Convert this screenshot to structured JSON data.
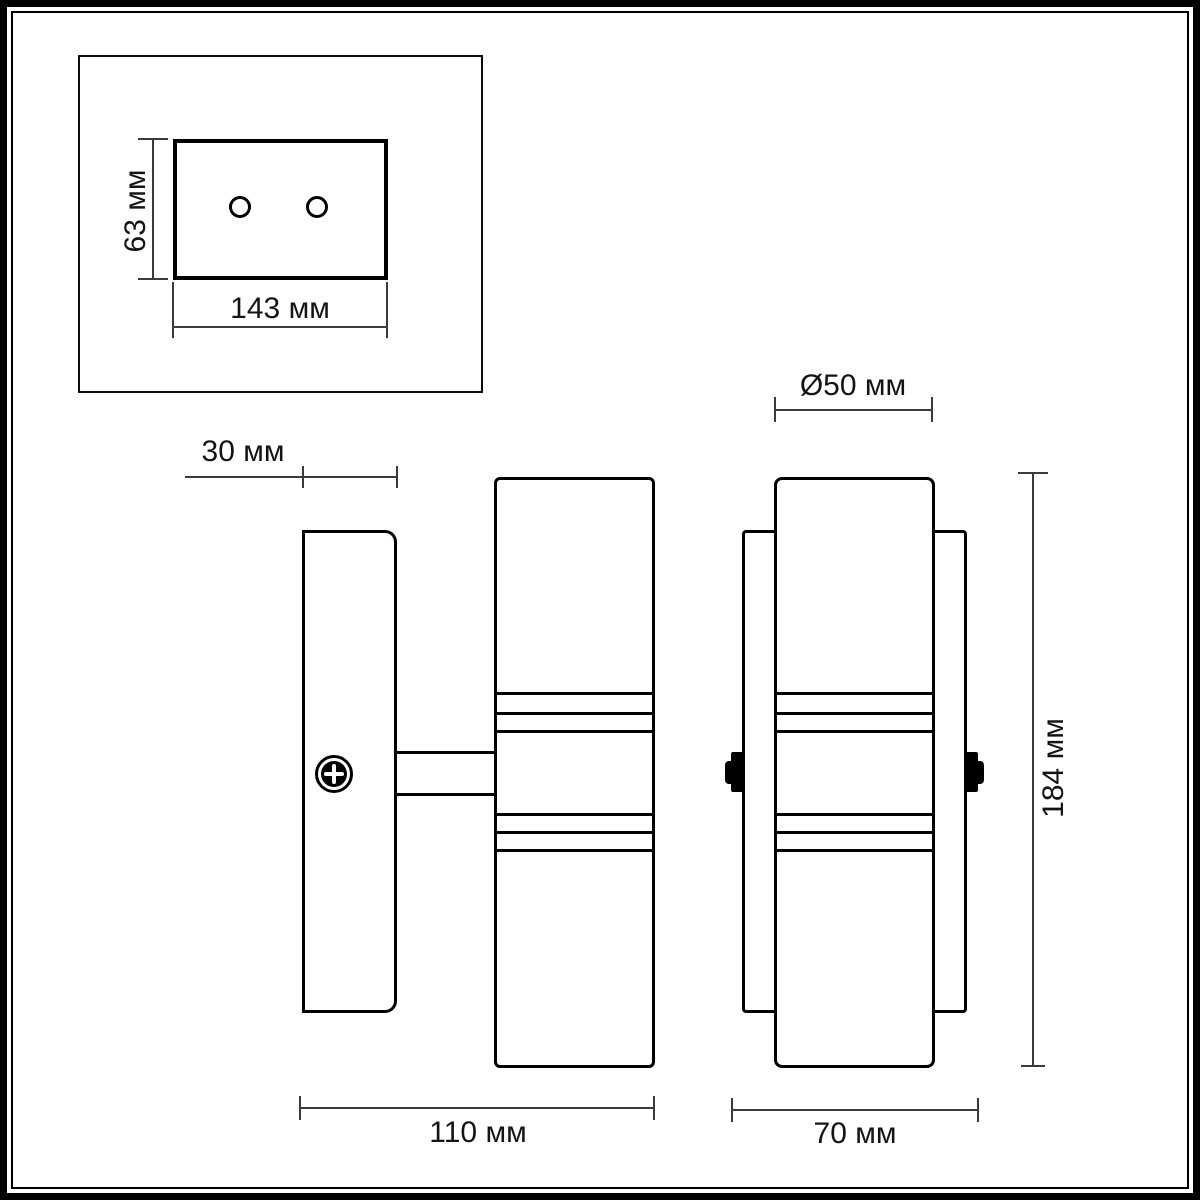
{
  "drawing": {
    "type": "technical-dimension-drawing",
    "subject": "two-lamp wall sconce with mounting plate",
    "views": {
      "mounting_plate_detail": {
        "height_label": "63 мм",
        "width_label": "143 мм",
        "hole_count": 2
      },
      "side_view": {
        "depth_label": "30 мм",
        "width_label": "110 мм"
      },
      "front_view": {
        "diameter_label": "Ø50 мм",
        "height_label": "184 мм",
        "width_label": "70 мм"
      }
    },
    "colors": {
      "line": "#000000",
      "dimension_line": "#3a3a3a",
      "background": "#ffffff"
    }
  }
}
